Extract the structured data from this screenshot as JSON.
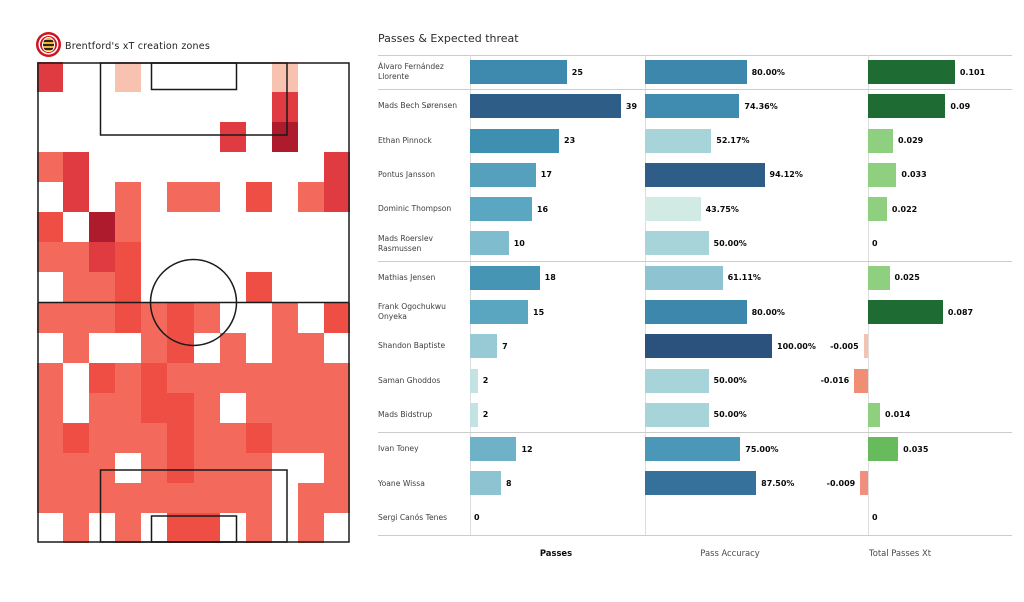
{
  "left_panel": {
    "title": "Brentford's xT creation zones",
    "logo": "brentford-crest-icon",
    "heatmap": {
      "rows": 16,
      "cols": 12,
      "palette": {
        "0": "transparent",
        "1": "#f8c2b1",
        "2": "#f3695b",
        "3": "#ee4e44",
        "4": "#e13b42",
        "5": "#ad1b2d"
      },
      "grid": [
        [
          4,
          0,
          0,
          1,
          0,
          0,
          0,
          0,
          0,
          1,
          0,
          0
        ],
        [
          0,
          0,
          0,
          0,
          0,
          0,
          0,
          0,
          0,
          4,
          0,
          0
        ],
        [
          0,
          0,
          0,
          0,
          0,
          0,
          0,
          4,
          0,
          5,
          0,
          0
        ],
        [
          2,
          4,
          0,
          0,
          0,
          0,
          0,
          0,
          0,
          0,
          0,
          4
        ],
        [
          0,
          4,
          0,
          2,
          0,
          2,
          2,
          0,
          3,
          0,
          2,
          4
        ],
        [
          3,
          0,
          5,
          2,
          0,
          0,
          0,
          0,
          0,
          0,
          0,
          0
        ],
        [
          2,
          2,
          4,
          3,
          0,
          0,
          0,
          0,
          0,
          0,
          0,
          0
        ],
        [
          0,
          2,
          2,
          3,
          0,
          0,
          0,
          0,
          3,
          0,
          0,
          0
        ],
        [
          2,
          2,
          2,
          3,
          2,
          3,
          2,
          0,
          0,
          2,
          0,
          3
        ],
        [
          0,
          2,
          0,
          0,
          2,
          3,
          0,
          2,
          0,
          2,
          2,
          0
        ],
        [
          2,
          0,
          3,
          2,
          3,
          2,
          2,
          2,
          2,
          2,
          2,
          2
        ],
        [
          2,
          0,
          2,
          2,
          3,
          3,
          2,
          0,
          2,
          2,
          2,
          2
        ],
        [
          2,
          3,
          2,
          2,
          2,
          3,
          2,
          2,
          3,
          2,
          2,
          2
        ],
        [
          2,
          2,
          2,
          0,
          2,
          3,
          2,
          2,
          2,
          0,
          0,
          2
        ],
        [
          2,
          2,
          2,
          2,
          2,
          2,
          2,
          2,
          2,
          0,
          2,
          2
        ],
        [
          0,
          2,
          0,
          2,
          0,
          3,
          3,
          0,
          2,
          0,
          2,
          0
        ]
      ]
    }
  },
  "right_panel": {
    "title": "Passes & Expected threat",
    "footers": {
      "passes": "Passes",
      "accuracy": "Pass Accuracy",
      "xt": "Total Passes Xt"
    },
    "players": [
      {
        "name": "Álvaro Fernández Llorente",
        "passes": 25,
        "passes_label": "25",
        "passes_color": "#3e89ae",
        "accuracy": 80.0,
        "accuracy_label": "80.00%",
        "accuracy_color": "#3d87ac",
        "xt": 0.101,
        "xt_label": "0.101",
        "xt_color": "#1e6b34",
        "group_end": true
      },
      {
        "name": "Mads Bech Sørensen",
        "passes": 39,
        "passes_label": "39",
        "passes_color": "#2e5d87",
        "accuracy": 74.36,
        "accuracy_label": "74.36%",
        "accuracy_color": "#3f8cb0",
        "xt": 0.09,
        "xt_label": "0.09",
        "xt_color": "#1e6b34",
        "group_end": false
      },
      {
        "name": "Ethan Pinnock",
        "passes": 23,
        "passes_label": "23",
        "passes_color": "#3e8fb0",
        "accuracy": 52.17,
        "accuracy_label": "52.17%",
        "accuracy_color": "#a6d4d8",
        "xt": 0.029,
        "xt_label": "0.029",
        "xt_color": "#8ed080",
        "group_end": false
      },
      {
        "name": "Pontus Jansson",
        "passes": 17,
        "passes_label": "17",
        "passes_color": "#55a1bd",
        "accuracy": 94.12,
        "accuracy_label": "94.12%",
        "accuracy_color": "#2e5d87",
        "xt": 0.033,
        "xt_label": "0.033",
        "xt_color": "#8ed080",
        "group_end": false
      },
      {
        "name": "Dominic  Thompson",
        "passes": 16,
        "passes_label": "16",
        "passes_color": "#5ba6c0",
        "accuracy": 43.75,
        "accuracy_label": "43.75%",
        "accuracy_color": "#d2eae4",
        "xt": 0.022,
        "xt_label": "0.022",
        "xt_color": "#8ed080",
        "group_end": false
      },
      {
        "name": "Mads Roerslev Rasmussen",
        "passes": 10,
        "passes_label": "10",
        "passes_color": "#7fbccd",
        "accuracy": 50.0,
        "accuracy_label": "50.00%",
        "accuracy_color": "#a6d4d8",
        "xt": 0,
        "xt_label": "0",
        "xt_color": null,
        "group_end": true
      },
      {
        "name": "Mathias Jensen",
        "passes": 18,
        "passes_label": "18",
        "passes_color": "#4795b5",
        "accuracy": 61.11,
        "accuracy_label": "61.11%",
        "accuracy_color": "#8ec4d1",
        "xt": 0.025,
        "xt_label": "0.025",
        "xt_color": "#8ed080",
        "group_end": false
      },
      {
        "name": "Frank Ogochukwu Onyeka",
        "passes": 15,
        "passes_label": "15",
        "passes_color": "#5aa5c0",
        "accuracy": 80.0,
        "accuracy_label": "80.00%",
        "accuracy_color": "#3d87ac",
        "xt": 0.087,
        "xt_label": "0.087",
        "xt_color": "#1e6b34",
        "group_end": false
      },
      {
        "name": "Shandon Baptiste",
        "passes": 7,
        "passes_label": "7",
        "passes_color": "#97cad4",
        "accuracy": 100.0,
        "accuracy_label": "100.00%",
        "accuracy_color": "#2a527c",
        "xt": -0.005,
        "xt_label": "-0.005",
        "xt_color": "#f2c3b3",
        "group_end": false
      },
      {
        "name": "Saman Ghoddos",
        "passes": 2,
        "passes_label": "2",
        "passes_color": "#c2e2e3",
        "accuracy": 50.0,
        "accuracy_label": "50.00%",
        "accuracy_color": "#a6d4d8",
        "xt": -0.016,
        "xt_label": "-0.016",
        "xt_color": "#f08d75",
        "group_end": false
      },
      {
        "name": "Mads Bidstrup",
        "passes": 2,
        "passes_label": "2",
        "passes_color": "#c2e2e3",
        "accuracy": 50.0,
        "accuracy_label": "50.00%",
        "accuracy_color": "#a6d4d8",
        "xt": 0.014,
        "xt_label": "0.014",
        "xt_color": "#8ed080",
        "group_end": true
      },
      {
        "name": "Ivan Toney",
        "passes": 12,
        "passes_label": "12",
        "passes_color": "#6fb2c7",
        "accuracy": 75.0,
        "accuracy_label": "75.00%",
        "accuracy_color": "#4a97b7",
        "xt": 0.035,
        "xt_label": "0.035",
        "xt_color": "#67bb5c",
        "group_end": false
      },
      {
        "name": "Yoane Wissa",
        "passes": 8,
        "passes_label": "8",
        "passes_color": "#8ec4d1",
        "accuracy": 87.5,
        "accuracy_label": "87.50%",
        "accuracy_color": "#35719b",
        "xt": -0.009,
        "xt_label": "-0.009",
        "xt_color": "#f0907c",
        "group_end": false
      },
      {
        "name": "Sergi Canós Tenes",
        "passes": 0,
        "passes_label": "0",
        "passes_color": null,
        "accuracy": null,
        "accuracy_label": null,
        "accuracy_color": null,
        "xt": 0,
        "xt_label": "0",
        "xt_color": null,
        "group_end": true
      }
    ]
  },
  "chart_data": [
    {
      "type": "heatmap",
      "title": "Brentford's xT creation zones",
      "description": "Vertical football pitch (attacking toward top) divided into a 12-wide × 16-tall zone grid; red intensity 0–5 encodes xT creation volume per zone",
      "rows": 16,
      "cols": 12,
      "intensity_scale": [
        0,
        1,
        2,
        3,
        4,
        5
      ],
      "grid": [
        [
          4,
          0,
          0,
          1,
          0,
          0,
          0,
          0,
          0,
          1,
          0,
          0
        ],
        [
          0,
          0,
          0,
          0,
          0,
          0,
          0,
          0,
          0,
          4,
          0,
          0
        ],
        [
          0,
          0,
          0,
          0,
          0,
          0,
          0,
          4,
          0,
          5,
          0,
          0
        ],
        [
          2,
          4,
          0,
          0,
          0,
          0,
          0,
          0,
          0,
          0,
          0,
          4
        ],
        [
          0,
          4,
          0,
          2,
          0,
          2,
          2,
          0,
          3,
          0,
          2,
          4
        ],
        [
          3,
          0,
          5,
          2,
          0,
          0,
          0,
          0,
          0,
          0,
          0,
          0
        ],
        [
          2,
          2,
          4,
          3,
          0,
          0,
          0,
          0,
          0,
          0,
          0,
          0
        ],
        [
          0,
          2,
          2,
          3,
          0,
          0,
          0,
          0,
          3,
          0,
          0,
          0
        ],
        [
          2,
          2,
          2,
          3,
          2,
          3,
          2,
          0,
          0,
          2,
          0,
          3
        ],
        [
          0,
          2,
          0,
          0,
          2,
          3,
          0,
          2,
          0,
          2,
          2,
          0
        ],
        [
          2,
          0,
          3,
          2,
          3,
          2,
          2,
          2,
          2,
          2,
          2,
          2
        ],
        [
          2,
          0,
          2,
          2,
          3,
          3,
          2,
          0,
          2,
          2,
          2,
          2
        ],
        [
          2,
          3,
          2,
          2,
          2,
          3,
          2,
          2,
          3,
          2,
          2,
          2
        ],
        [
          2,
          2,
          2,
          0,
          2,
          3,
          2,
          2,
          2,
          0,
          0,
          2
        ],
        [
          2,
          2,
          2,
          2,
          2,
          2,
          2,
          2,
          2,
          0,
          2,
          2
        ],
        [
          0,
          2,
          0,
          2,
          0,
          3,
          3,
          0,
          2,
          0,
          2,
          0
        ]
      ]
    },
    {
      "type": "bar",
      "title": "Passes & Expected threat",
      "orientation": "horizontal",
      "categories": [
        "Álvaro Fernández Llorente",
        "Mads Bech Sørensen",
        "Ethan Pinnock",
        "Pontus Jansson",
        "Dominic  Thompson",
        "Mads Roerslev Rasmussen",
        "Mathias Jensen",
        "Frank Ogochukwu Onyeka",
        "Shandon Baptiste",
        "Saman Ghoddos",
        "Mads Bidstrup",
        "Ivan Toney",
        "Yoane Wissa",
        "Sergi Canós Tenes"
      ],
      "series": [
        {
          "name": "Passes",
          "values": [
            25,
            39,
            23,
            17,
            16,
            10,
            18,
            15,
            7,
            2,
            2,
            12,
            8,
            0
          ]
        },
        {
          "name": "Pass Accuracy",
          "values": [
            80.0,
            74.36,
            52.17,
            94.12,
            43.75,
            50.0,
            61.11,
            80.0,
            100.0,
            50.0,
            50.0,
            75.0,
            87.5,
            null
          ]
        },
        {
          "name": "Total Passes Xt",
          "values": [
            0.101,
            0.09,
            0.029,
            0.033,
            0.022,
            0,
            0.025,
            0.087,
            -0.005,
            -0.016,
            0.014,
            0.035,
            -0.009,
            0
          ]
        }
      ],
      "legend_position": "none",
      "grid_on": false,
      "xlim_passes": [
        0,
        40
      ],
      "xlim_accuracy": [
        0,
        100
      ],
      "xlim_xt": [
        -0.02,
        0.11
      ]
    }
  ]
}
